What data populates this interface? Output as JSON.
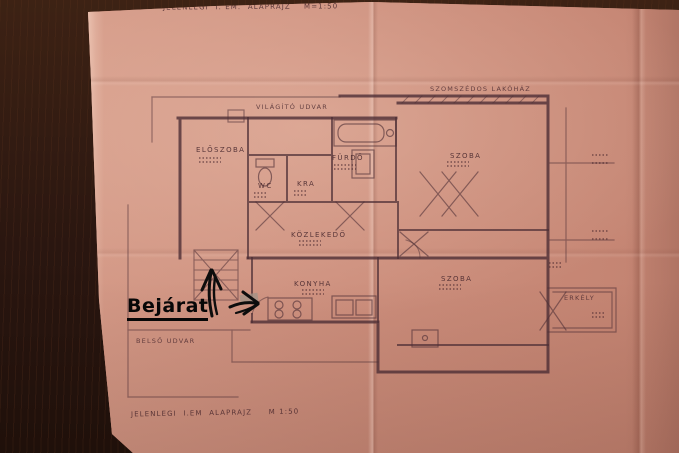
{
  "titles": {
    "top": "JELENLEGI  I. EM.  ALAPRAJZ    M=1:50",
    "bottom": "JELENLEGI  I.EM  ALAPRAJZ     M 1:50"
  },
  "plan": {
    "areas": {
      "light_court": "VILÁGÍTÓ UDVAR",
      "neighbor_house": "SZOMSZÉDOS LAKÓHÁZ",
      "inner_court": "BELSŐ UDVAR"
    },
    "rooms": {
      "eloszoba": "ELŐSZOBA",
      "wc": "WC",
      "kamra": "KRA",
      "furdo": "FÜRDŐ",
      "szoba_top": "SZOBA",
      "kozlekedo": "KÖZLEKEDŐ",
      "konyha": "KONYHA",
      "szoba_bottom": "SZOBA",
      "erkely": "ERKÉLY"
    }
  },
  "annotation": {
    "entrance": "Bejárat"
  },
  "colors": {
    "paper": "#cc8e7c",
    "wood": "#2e1810",
    "ink": "#4e2f36",
    "annotation_ink": "#070707"
  }
}
